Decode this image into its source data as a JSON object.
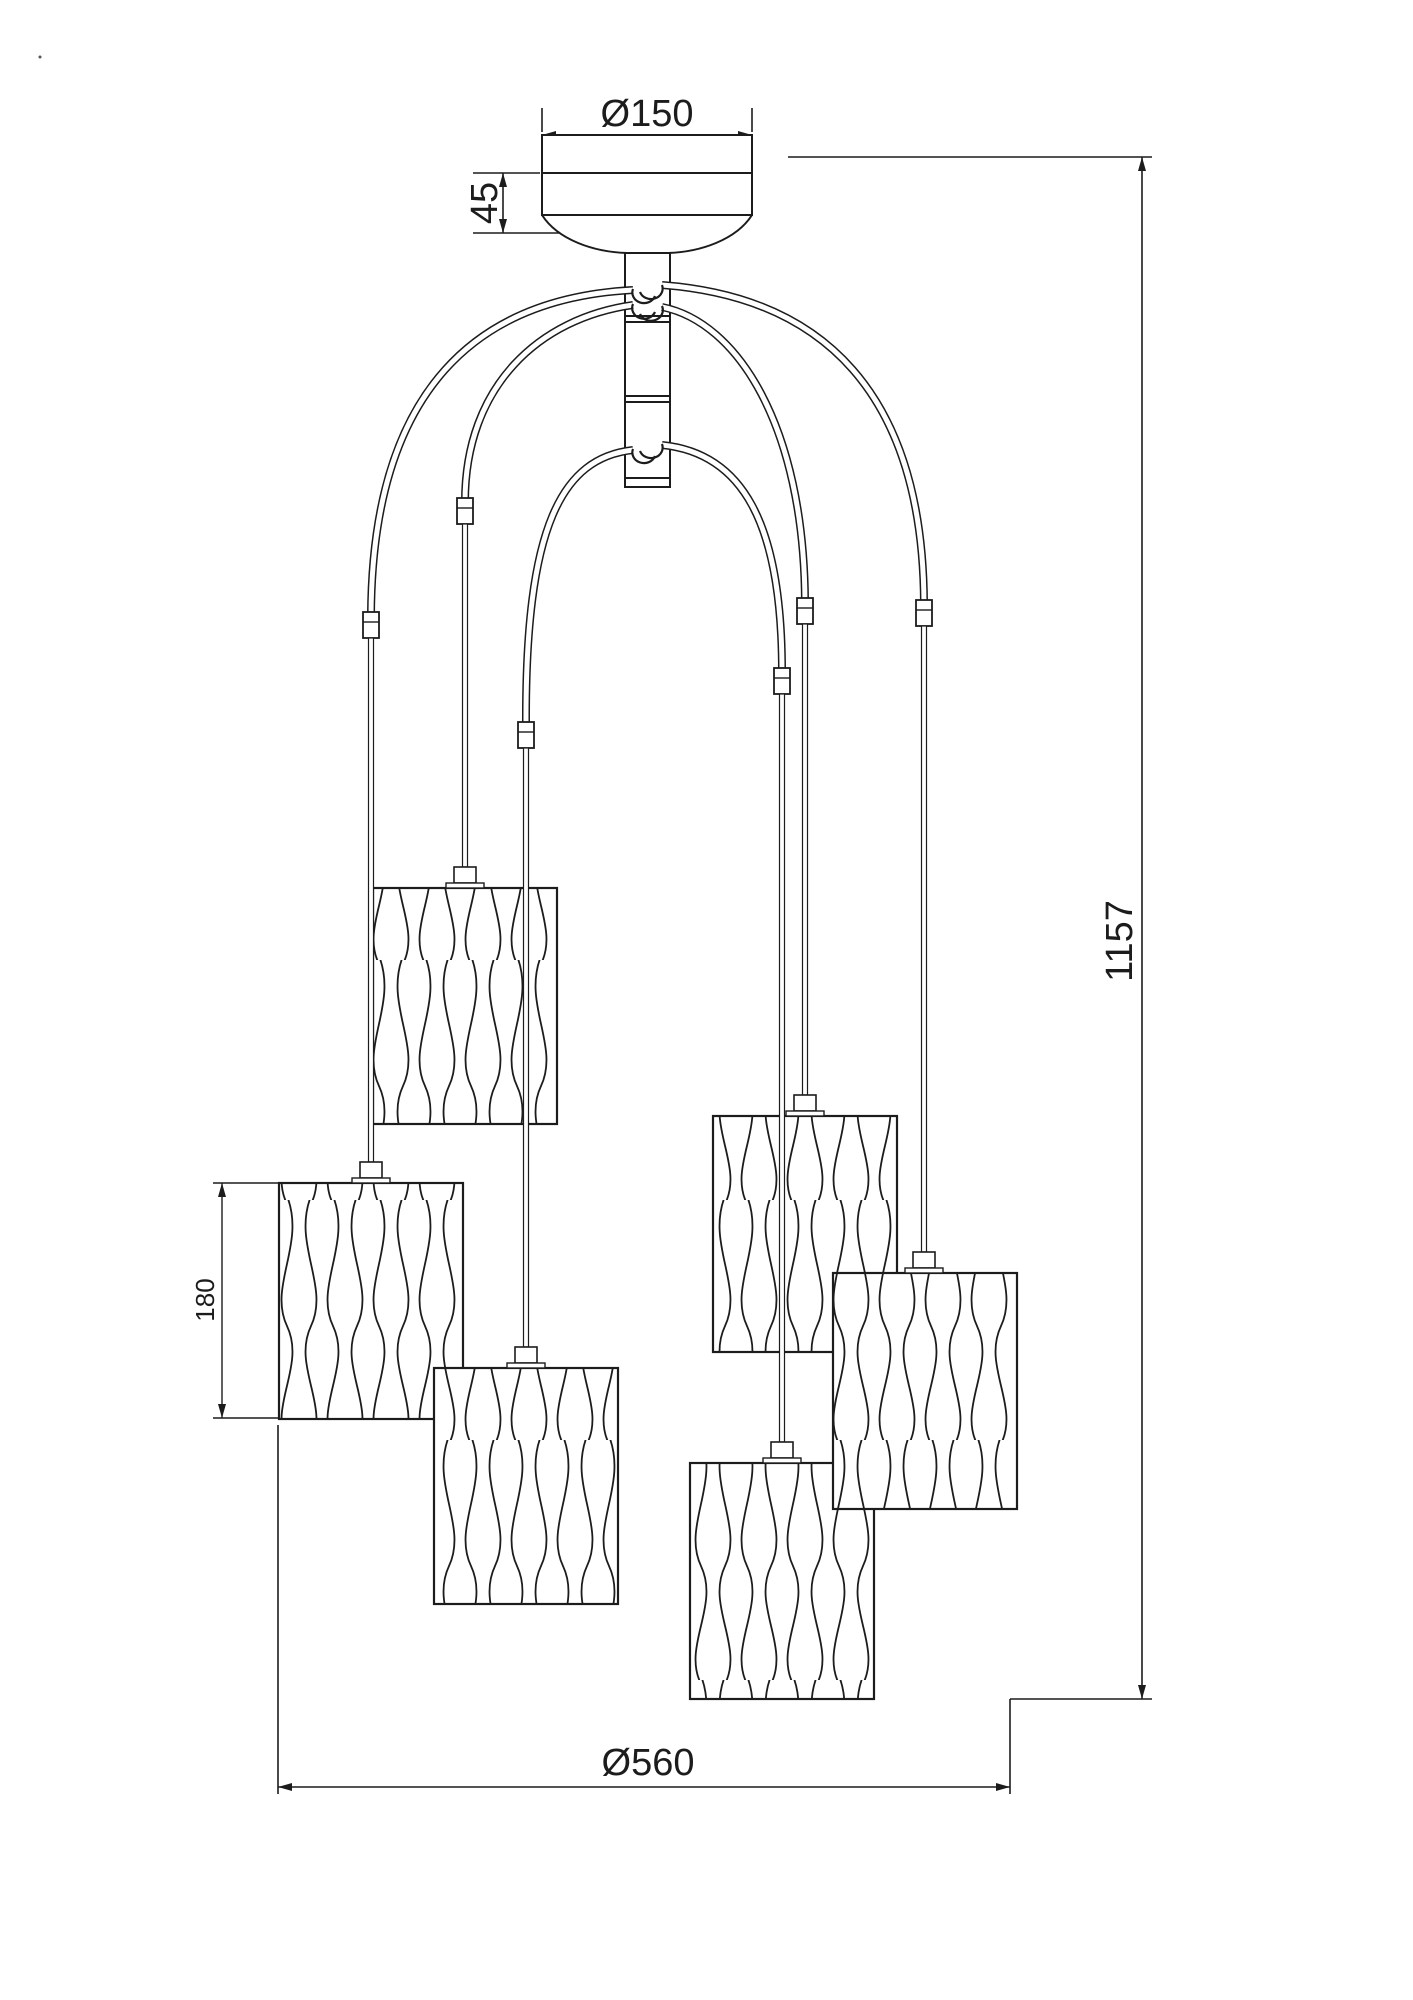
{
  "colors": {
    "line": "#1c1c1c",
    "background": "#ffffff"
  },
  "labels": {
    "canopy_diameter": "Ø150",
    "canopy_height": "45",
    "total_height": "1157",
    "shade_height": "180",
    "overall_diameter": "Ø560"
  },
  "figure": {
    "shade_count": 6
  }
}
